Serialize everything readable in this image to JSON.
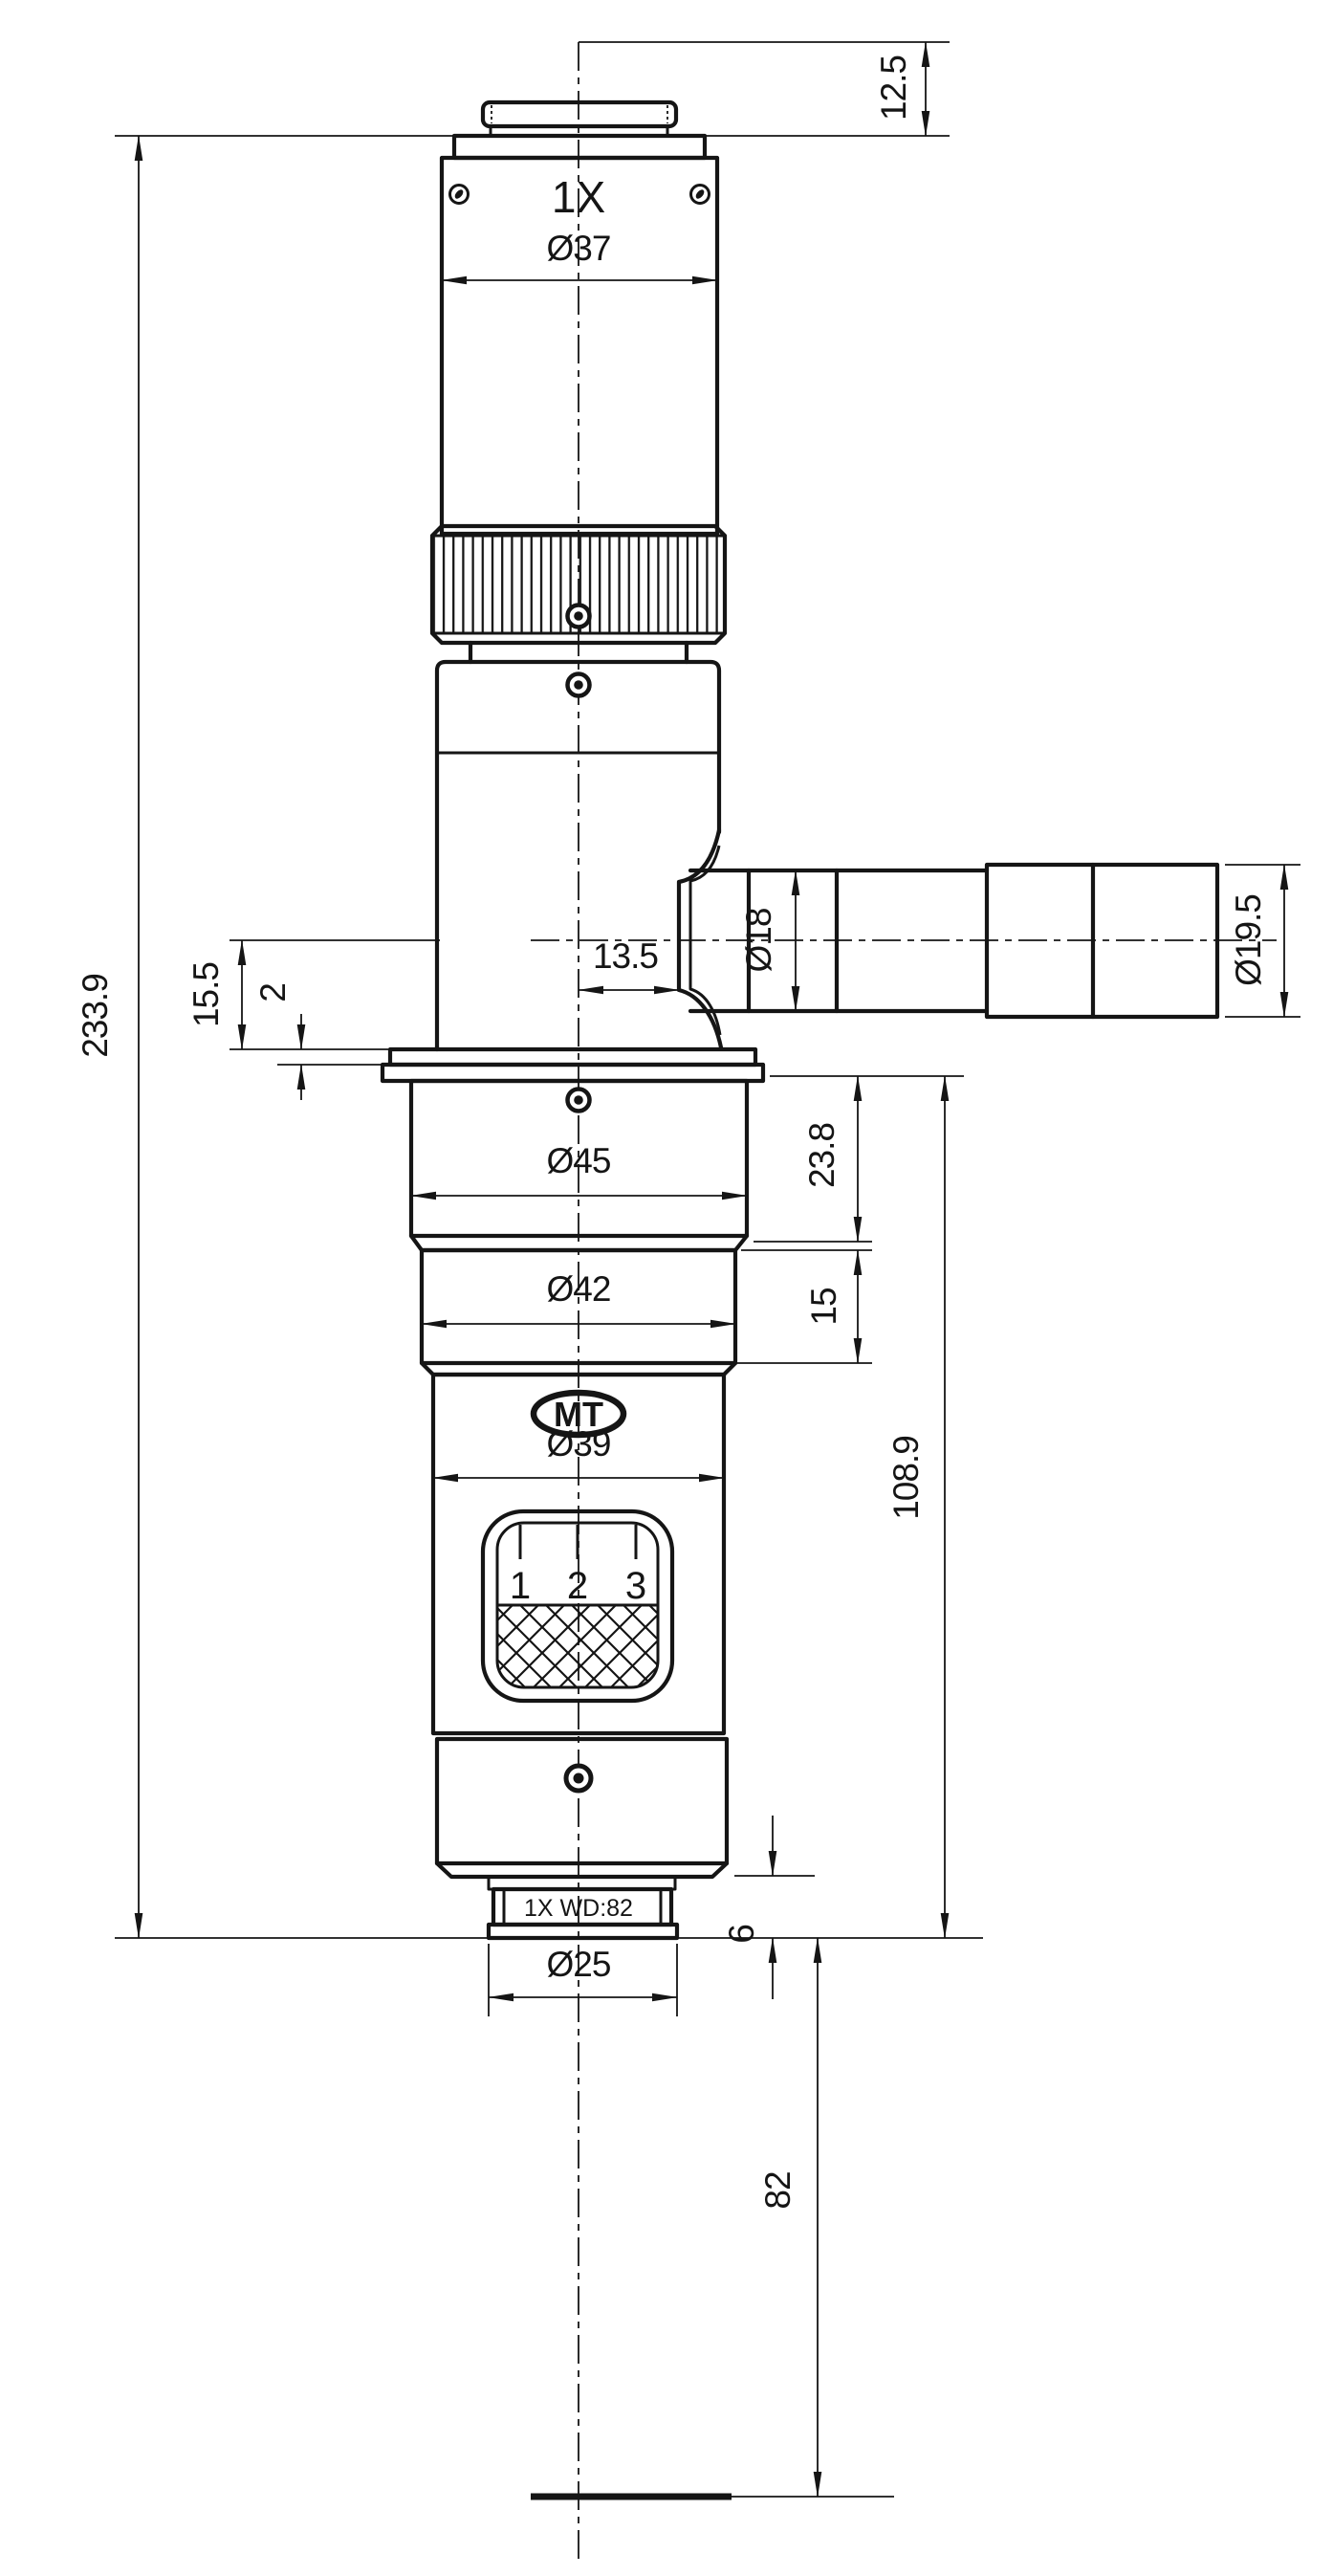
{
  "drawing": {
    "labels": {
      "magnification": "1X",
      "logo": "MT",
      "objective": "1X WD:82"
    },
    "zoom_scale_marks": [
      "1",
      "2",
      "3"
    ],
    "dims": {
      "cap_height": "12.5",
      "total_height": "233.9",
      "body_dia": "Ø37",
      "arm_offset": "13.5",
      "arm_axis_drop": "15.5",
      "flange_lip": "2",
      "port_dia": "Ø18",
      "port_end_dia": "Ø19.5",
      "flange_dia": "Ø45",
      "flange_height": "23.8",
      "mid_dia": "Ø42",
      "mid_height": "15",
      "lower_dia": "Ø39",
      "lower_height": "108.9",
      "objective_dia": "Ø25",
      "objective_step": "6",
      "working_distance": "82"
    }
  }
}
